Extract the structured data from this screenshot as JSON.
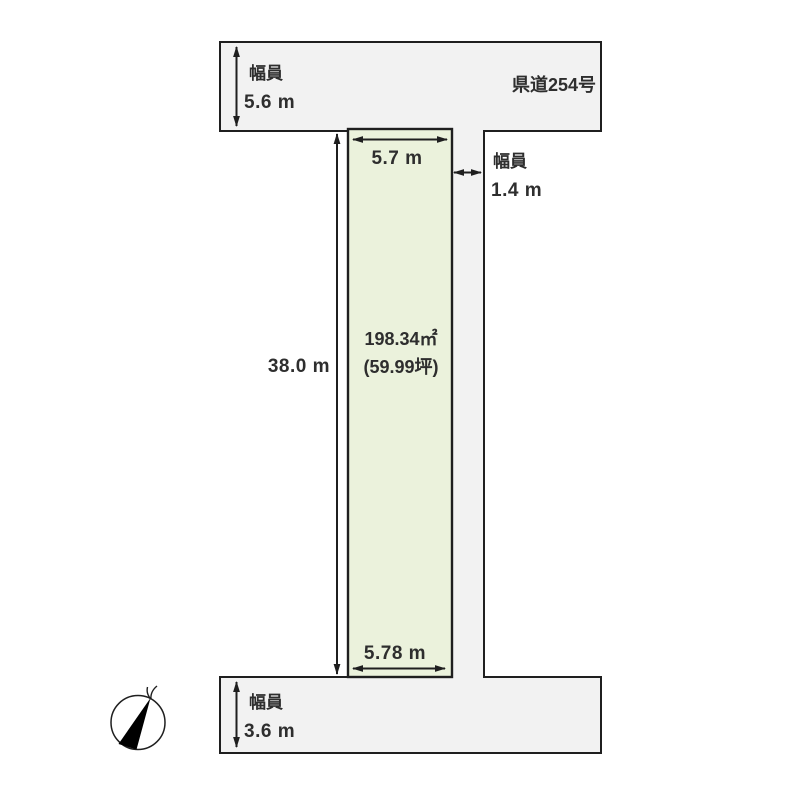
{
  "colors": {
    "background": "#ffffff",
    "road_fill": "#f2f2f2",
    "parcel_fill": "#ebf2dc",
    "line": "#1f1f1f",
    "text": "#2e2e2e"
  },
  "roads": {
    "top": {
      "name": "県道254号",
      "width_caption": "幅員",
      "width_value": "5.6 m"
    },
    "side": {
      "width_caption": "幅員",
      "width_value": "1.4 m"
    },
    "bottom": {
      "width_caption": "幅員",
      "width_value": "3.6 m"
    }
  },
  "parcel": {
    "area": "198.34㎡",
    "area_tsubo": "(59.99坪)",
    "frontage_top": "5.7 m",
    "frontage_bottom": "5.78 m",
    "depth": "38.0 m"
  },
  "icons": {
    "compass": "north-compass"
  }
}
